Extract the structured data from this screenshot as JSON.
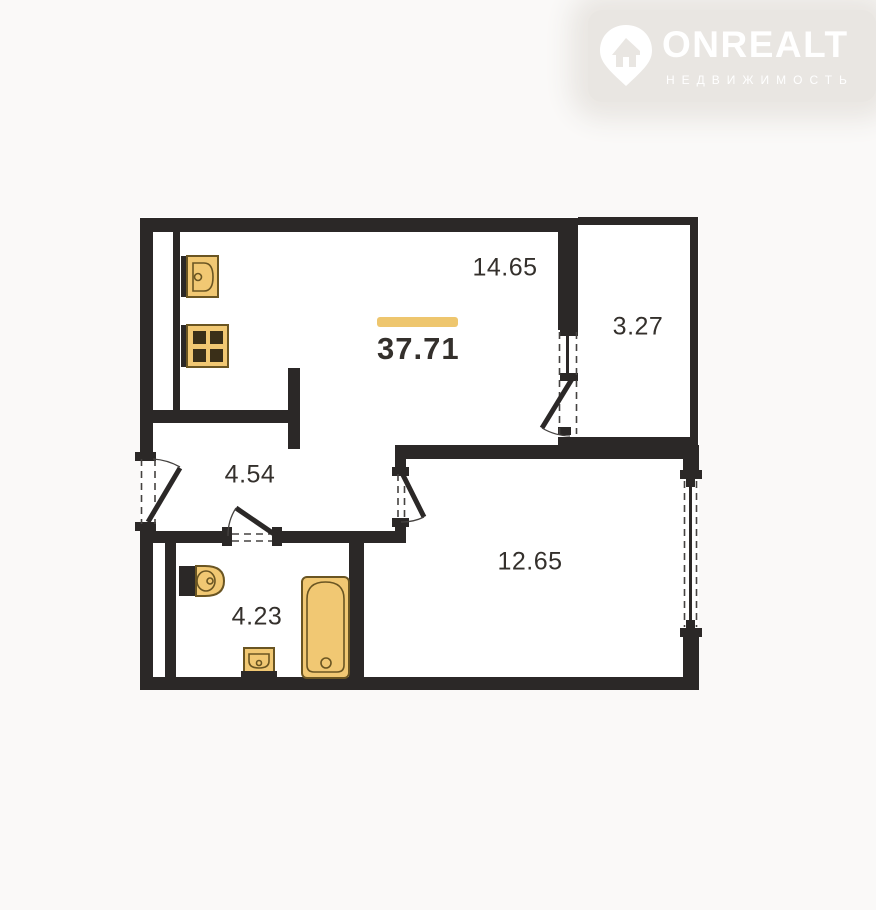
{
  "logo": {
    "brand": "ONREALT",
    "tagline": "НЕДВИЖИМОСТЬ"
  },
  "plan": {
    "total_area": "37.71",
    "rooms": [
      {
        "id": "living-room",
        "area": "14.65"
      },
      {
        "id": "loggia",
        "area": "3.27"
      },
      {
        "id": "hallway",
        "area": "4.54"
      },
      {
        "id": "bathroom",
        "area": "4.23"
      },
      {
        "id": "bedroom",
        "area": "12.65"
      }
    ]
  },
  "colors": {
    "wall": "#2b2827",
    "accent": "#eec66e",
    "fixture": "#f1c873",
    "fixture_outline": "#6a5522",
    "burner": "#3a2f18",
    "text": "#34302c",
    "background": "#faf9f8",
    "floor": "#ffffff",
    "line": "#454240",
    "logo": "#ffffff",
    "logo_plate": "#e9e6e2"
  }
}
